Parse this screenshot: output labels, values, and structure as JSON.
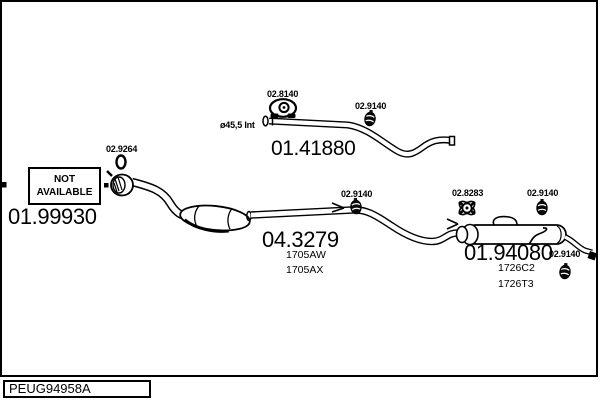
{
  "footer": {
    "catalog_code": "PEUG94958A"
  },
  "colors": {
    "line": "#000000",
    "background": "#ffffff"
  },
  "parts": {
    "not_available_box": {
      "line1": "NOT",
      "line2": "AVAILABLE"
    },
    "front_pipe": {
      "number": "01.99930"
    },
    "front_gasket": {
      "number": "02.9264"
    },
    "hanger_top": {
      "number": "02.8140"
    },
    "top_pipe": {
      "number": "01.41880",
      "diameter_note": "ø45,5 Int"
    },
    "clamp_top_pipe": {
      "number": "02.9140"
    },
    "catalytic_converter": {
      "number": "04.3279",
      "variants": [
        "1705AW",
        "1705AX"
      ]
    },
    "clamp_mid_pipe": {
      "number": "02.9140"
    },
    "hanger_rear": {
      "number": "02.8283"
    },
    "clamp_rear": {
      "number": "02.9140"
    },
    "rear_silencer": {
      "number": "01.94080",
      "variants": [
        "1726C2",
        "1726T3"
      ]
    },
    "clamp_tailpipe": {
      "number": "02.9140"
    }
  }
}
